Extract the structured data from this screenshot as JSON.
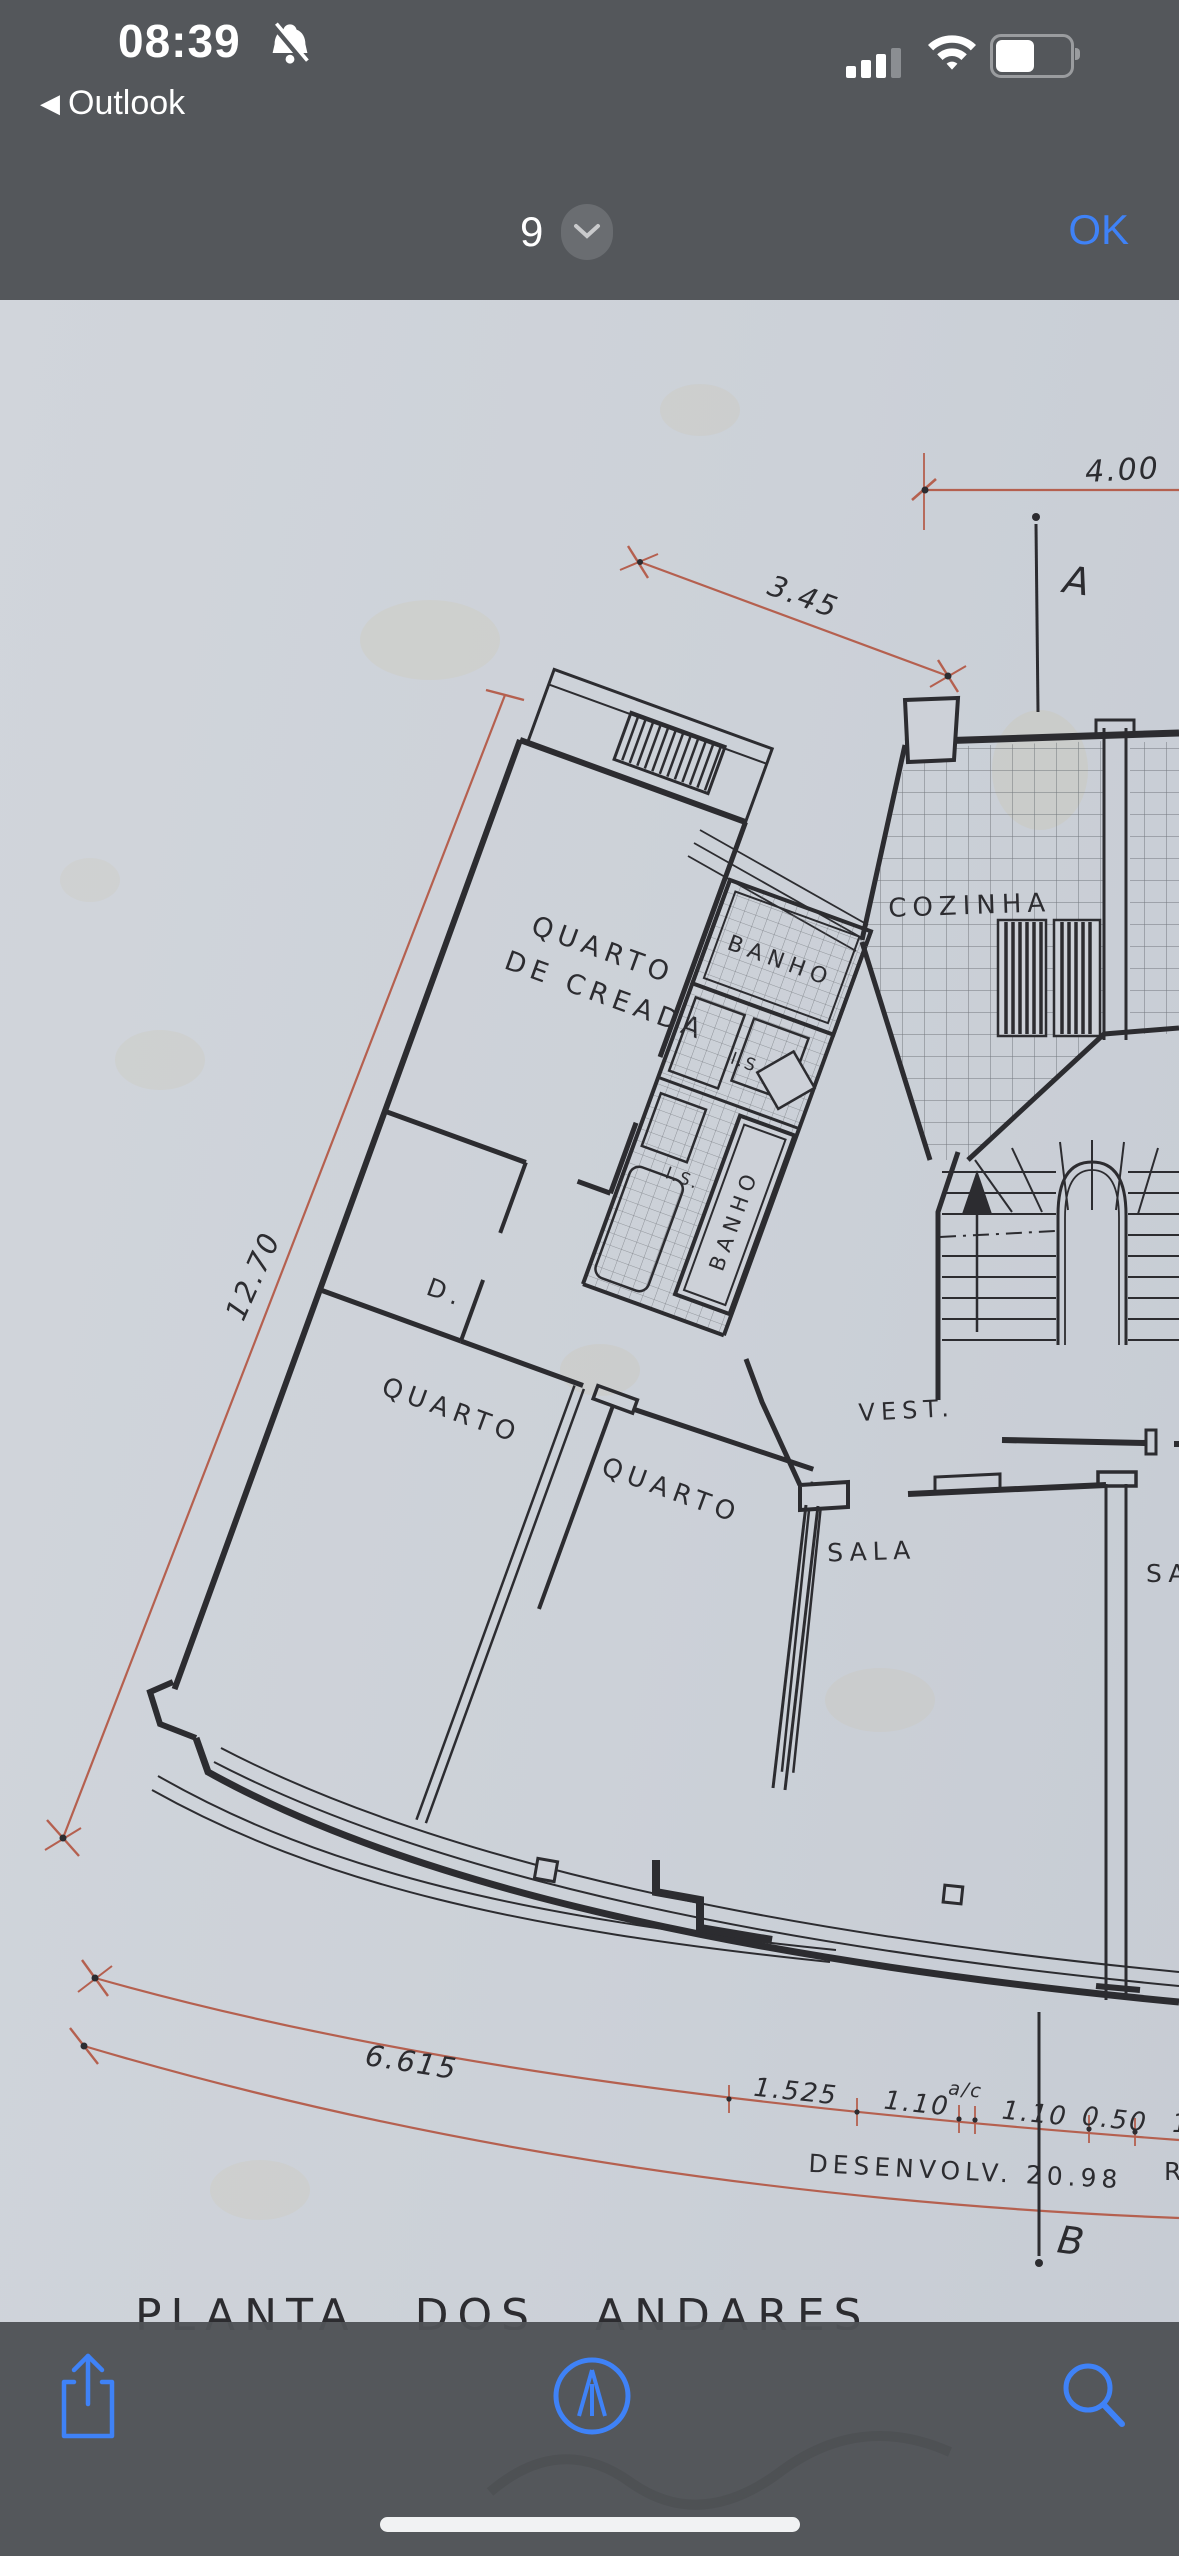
{
  "colors": {
    "chrome_bg": "#54575b",
    "accent": "#3f82f7",
    "paper": "#cdd1d8",
    "ink": "#2c2c30",
    "red": "#b5604f"
  },
  "status_bar": {
    "time": "08:39",
    "back_chevron": "◀",
    "back_app": "Outlook",
    "silent_icon": "bell-slash-icon",
    "signal_icon": "cellular-signal-icon",
    "wifi_icon": "wifi-icon",
    "battery_icon": "battery-icon"
  },
  "nav_bar": {
    "page_number": "9",
    "selector_icon": "chevron-down-icon",
    "ok_label": "OK"
  },
  "plan": {
    "title": "PLANTA  DOS  ANDARES",
    "rooms": {
      "maid1": "QUARTO",
      "maid2": "DE CREADA",
      "bath_upper": "BANHO",
      "bath_lower": "BANHO",
      "kitchen": "COZINHA",
      "is_upper": "I.S.",
      "is_lower": "I.S.",
      "closet": "D.",
      "bedroom_left": "QUARTO",
      "bedroom_mid": "QUARTO",
      "vest": "VEST.",
      "sala": "SALA",
      "sala_partial": "SA"
    },
    "dims": {
      "d400": "4.00",
      "d345": "3.45",
      "d1270": "12.70",
      "d6615": "6.615",
      "s1": "1.525",
      "s2": "1.10",
      "sac": "a/c",
      "s3": "1.10",
      "s4": "0.50",
      "s5": "1",
      "dev": "DESENVOLV.  20.98",
      "dev2": "R"
    },
    "axes": {
      "a": "A",
      "b": "B"
    }
  },
  "toolbar": {
    "share_icon": "share-icon",
    "markup_icon": "markup-icon",
    "search_icon": "search-icon"
  }
}
